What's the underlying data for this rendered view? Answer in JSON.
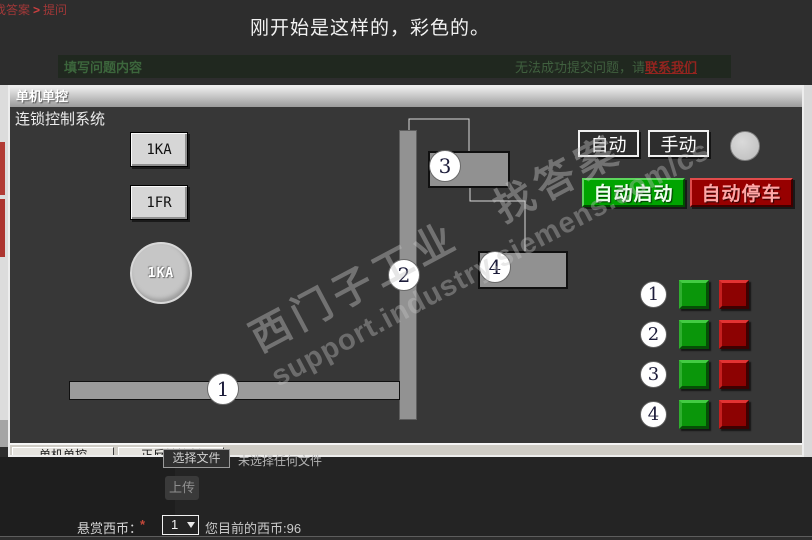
{
  "page": {
    "breadcrumb": {
      "part1": "找答案",
      "sep": ">",
      "part2": "提问"
    },
    "title": "刚开始是这样的，彩色的。",
    "form_header": {
      "label": "填写问题内容",
      "warning": "无法成功提交问题，请",
      "link": "联系我们"
    },
    "upload": {
      "choose_file": "选择文件",
      "no_file": "未选择任何文件",
      "upload_button": "上传"
    },
    "reward": {
      "label": "悬赏西币：",
      "required_mark": "*",
      "selected_value": "1",
      "balance_text": "您目前的西币:96"
    }
  },
  "hmi": {
    "window_title": "单机单控",
    "system_label": "连锁控制系统",
    "push_buttons": {
      "b1": "1KA",
      "b2": "1FR"
    },
    "motor_circle_label": "1KA",
    "diagram": {
      "c1": "1",
      "c2": "2",
      "c3": "3",
      "c4": "4"
    },
    "mode": {
      "auto": "自动",
      "manual": "手动"
    },
    "actions": {
      "start": "自动启动",
      "stop": "自动停车"
    },
    "indicators": {
      "rows": [
        {
          "label": "1"
        },
        {
          "label": "2"
        },
        {
          "label": "3"
        },
        {
          "label": "4"
        }
      ]
    },
    "tabs": [
      "单机单控",
      "正反转控制"
    ],
    "watermark": {
      "line1": "西门子工业　找答案",
      "line2": "support.industry.siemens.com/cs"
    },
    "colors": {
      "start_green": "#00a400",
      "stop_red": "#970000",
      "indicator_green": "#0a960a",
      "indicator_red": "#8d0202",
      "panel_bg": "#373737"
    }
  }
}
